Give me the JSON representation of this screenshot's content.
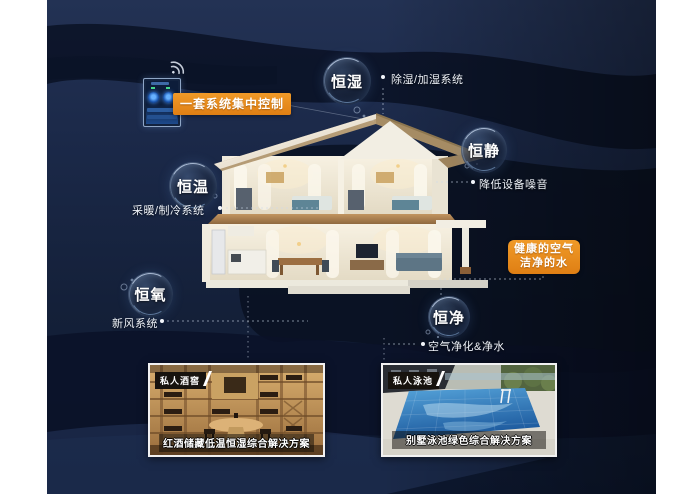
{
  "bubbles": [
    {
      "label": "恒湿",
      "desc": "除湿/加湿系统"
    },
    {
      "label": "恒静",
      "desc": "降低设备噪音"
    },
    {
      "label": "恒温",
      "desc": "采暖/制冷系统"
    },
    {
      "label": "恒氧",
      "desc": "新风系统"
    },
    {
      "label": "恒净",
      "desc": "空气净化&净水"
    }
  ],
  "callouts": {
    "central_control": "一套系统集中控制",
    "healthy_line1": "健康的空气",
    "healthy_line2": "洁净的水"
  },
  "photos": [
    {
      "tag": "私人酒窖",
      "caption": "红酒储藏低温恒湿综合解决方案"
    },
    {
      "tag": "私人泳池",
      "caption": "别墅泳池绿色综合解决方案"
    }
  ],
  "icons": [
    {
      "name": "wifi-icon"
    },
    {
      "name": "smart-panel-icon"
    }
  ],
  "colors": {
    "accent_orange": "#e8891d",
    "panel_navy": "#1b2947",
    "dark_band": "#0a1226",
    "text_white": "#f5f7fa"
  }
}
